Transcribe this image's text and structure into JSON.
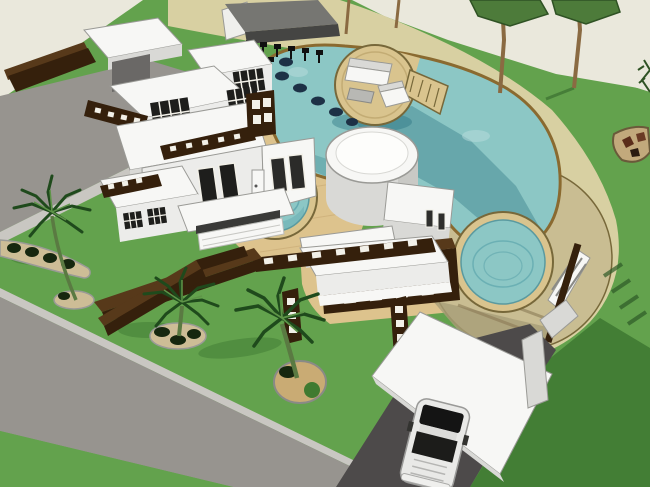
{
  "scene": {
    "description": "SketchUp-style 3D aerial rendering of a modern white flat-roof villa with a free-form teal swimming pool, a round lounge island with white sofa and steps, two circular spa pools, tan paver decks, a curving beige garden path, a bar pavilion with black stools, angular palm trees in round planting beds, dark-brown slotted pergolas and screen walls, a perimeter asphalt road, and a white carport sheltering a white pickup truck",
    "style": "sketchup-3d-render",
    "objects": [
      "main-house",
      "entrance-gate-canopy",
      "swimming-pool",
      "lounge-island",
      "spa-pool-left",
      "spa-pool-right",
      "round-tower-building",
      "pool-bar-pavilion",
      "bar-stools",
      "garden-path",
      "paver-deck",
      "round-deck-terrace",
      "pergola-canopy",
      "zigzag-screen-wall",
      "louver-wall",
      "carport",
      "pickup-truck",
      "driveway",
      "perimeter-road",
      "palm-trees",
      "shade-trees",
      "planting-beds",
      "rock-garden"
    ]
  },
  "colors": {
    "bg": "#eae8dc",
    "lawn": "#63a24d",
    "lawnShadow": "#3f7a33",
    "road": "#97948f",
    "roadCurb": "#c9c7c2",
    "driveway": "#4d4a4a",
    "path": "#d8d0a2",
    "deckPavers": "#ddc38d",
    "deckCircle": "#c9bd92",
    "deckShade": "#a89d78",
    "water": "#8cc7c5",
    "waterDeep": "#55a0a8",
    "waterShadow": "#2f7784",
    "waterLight": "#b9dedd",
    "coping": "#8a6a30",
    "island": "#d9c48e",
    "islandEdge": "#77683a",
    "white": "#f7f7f5",
    "whiteLight": "#ececea",
    "whiteShade": "#d9d9d6",
    "brownDark": "#35200c",
    "brownMid": "#57391a",
    "windowDark": "#1e1e1c",
    "slotWhite": "#f2f0e8",
    "outlineGray": "#9a9a96",
    "treeTrunk": "#8a6a42",
    "treeCanopy": "#4d7b3a",
    "treeCanopyEdge": "#2f5224",
    "palmLeaf": "#5e9448",
    "palmLeafDark": "#1f4a1c",
    "palmTrunk": "#5a7a42",
    "soil": "#c9ab74",
    "bedSand": "#cdbd96",
    "shrubDark": "#16270f",
    "bush": "#3f7a30",
    "rockSand": "#c2a97c",
    "rockRed": "#5a2c1a",
    "pavilionRoof": "#767672",
    "pavilionFascia": "#454543",
    "stool": "#101010",
    "carBody": "#e9e9e7",
    "carWindow": "#141414",
    "navyRock": "#1d3146"
  }
}
